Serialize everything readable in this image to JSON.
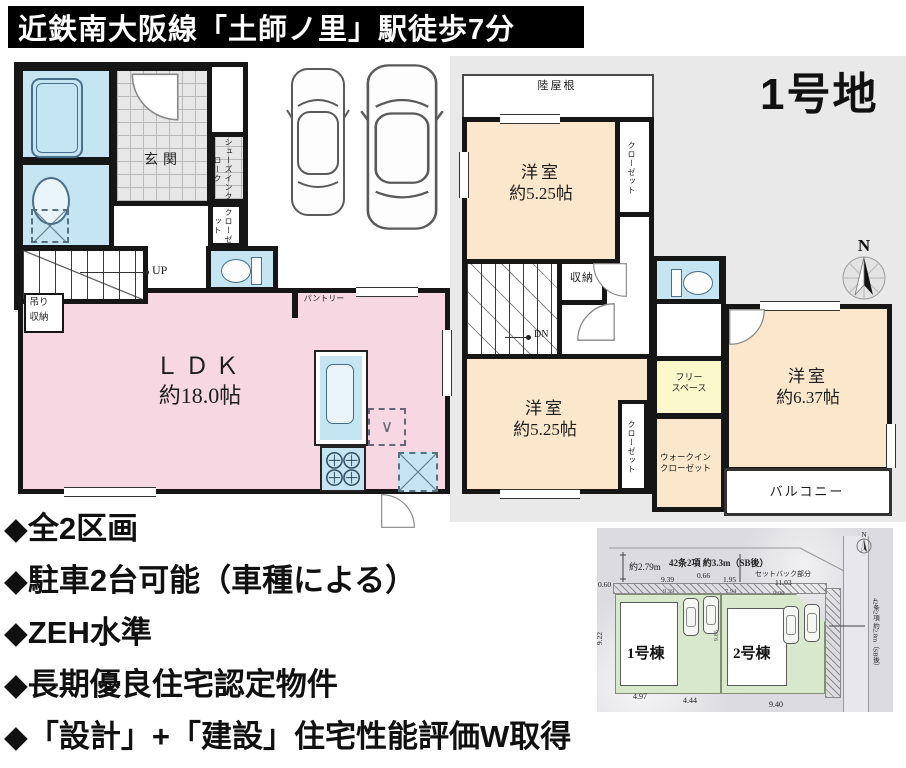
{
  "banner": {
    "text": "近鉄南大阪線「土師ノ里」駅徒歩7分"
  },
  "lot_title": "1号地",
  "floor1": {
    "genkan": "玄関",
    "shoes_cloak": "シューズインクローク",
    "closet": "クローゼット",
    "up": "UP",
    "hanging_storage": "吊り収納",
    "pantry": "パントリー",
    "ldk": "ＬＤＫ",
    "ldk_size": "約18.0帖"
  },
  "floor2": {
    "flat_roof": "陸屋根",
    "room1": "洋室",
    "room1_size": "約5.25帖",
    "closet1": "クローゼット",
    "storage": "収納",
    "dn": "DN",
    "room2": "洋室",
    "room2_size": "約5.25帖",
    "closet2": "クローゼット",
    "free_space_1": "フリー",
    "free_space_2": "スペース",
    "wic_1": "ウォークイン",
    "wic_2": "クローゼット",
    "room3": "洋室",
    "room3_size": "約6.37帖",
    "balcony": "バルコニー"
  },
  "compass": {
    "n": "N"
  },
  "features": [
    "◆全2区画",
    "◆駐車2台可能（車種による）",
    "◆ZEH水準",
    "◆長期優良住宅認定物件",
    "◆「設計」+「建設」住宅性能評価W取得"
  ],
  "site_plan": {
    "left_dim": "約2.79m",
    "top_dim": "42条2項 約3.3m（SB後）",
    "setback": "セットバック部分",
    "right_dim": "42条2項 約2.8m（SB後）",
    "house1": "1号棟",
    "house2": "2号棟",
    "top_numbers": [
      "0.60",
      "9.39",
      "0.66",
      "1.95",
      "11.03"
    ],
    "mid_numbers": [
      "9.39",
      "7.94",
      "9.96"
    ],
    "left_number": "9.22",
    "mid_vertical": "9.85",
    "bottom_numbers": [
      "4.97",
      "4.44",
      "9.40"
    ]
  },
  "colors": {
    "banner_bg": "#000000",
    "ldk_pink": "#f7d7e2",
    "room_beige": "#fbe7cb",
    "water_blue": "#c6e5f3",
    "free_space_yellow": "#fbf8cb",
    "site_green": "#d8e8cd"
  }
}
